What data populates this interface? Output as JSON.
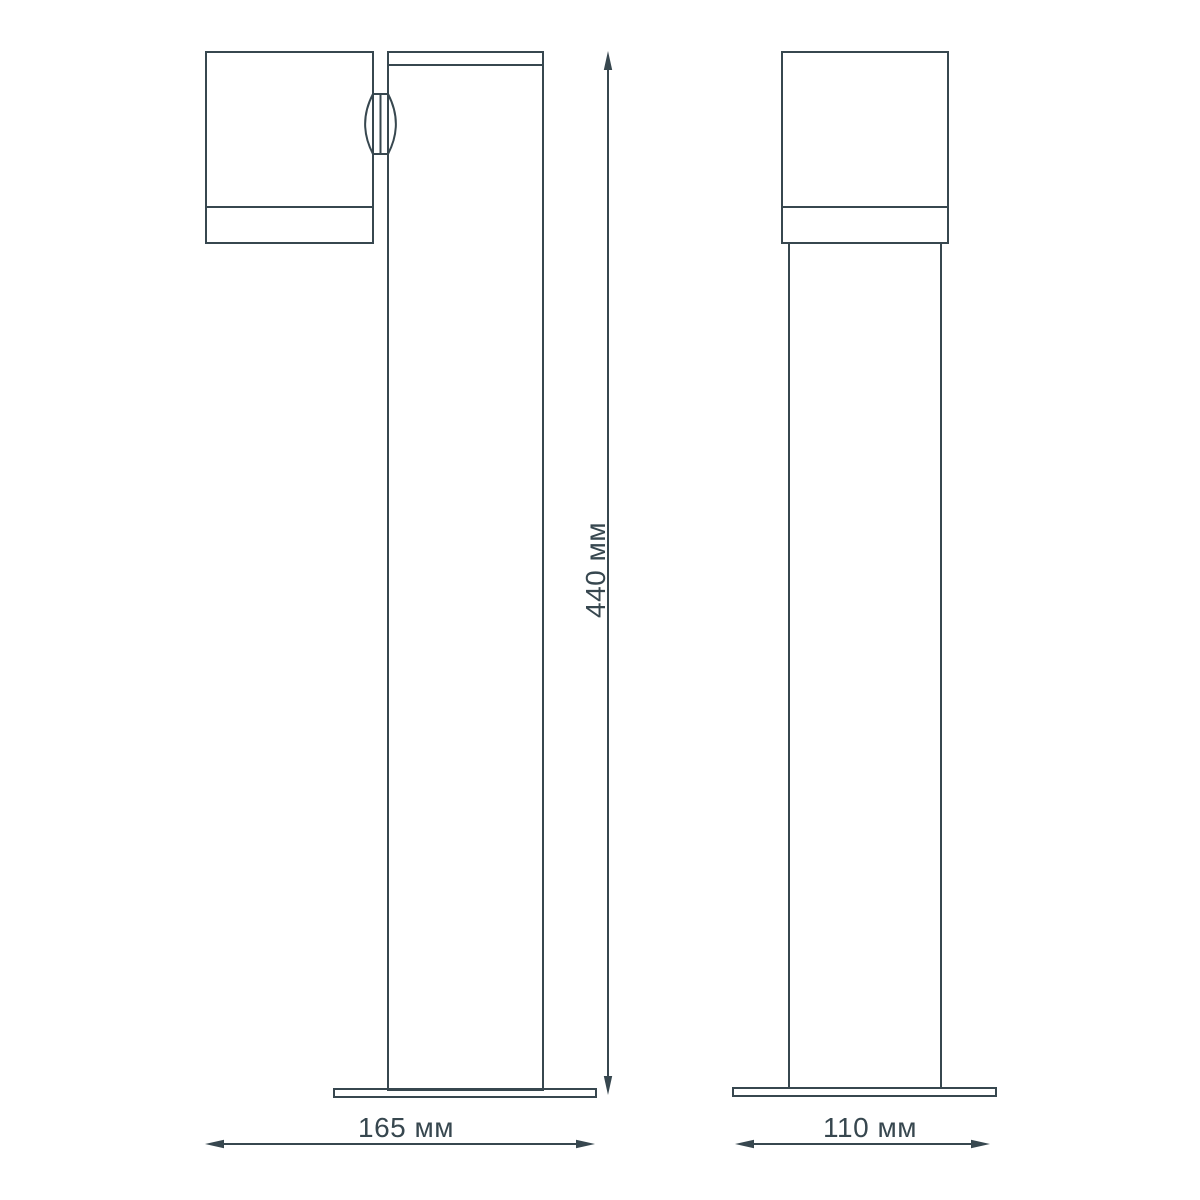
{
  "colors": {
    "line": "#37474f",
    "text": "#37474f",
    "background": "#ffffff"
  },
  "dimensions": {
    "height": {
      "label": "440 мм",
      "value": 440,
      "unit": "мм"
    },
    "side_overall_width": {
      "label": "165 мм",
      "value": 165,
      "unit": "мм"
    },
    "front_base_width": {
      "label": "110 мм",
      "value": 110,
      "unit": "мм"
    }
  }
}
